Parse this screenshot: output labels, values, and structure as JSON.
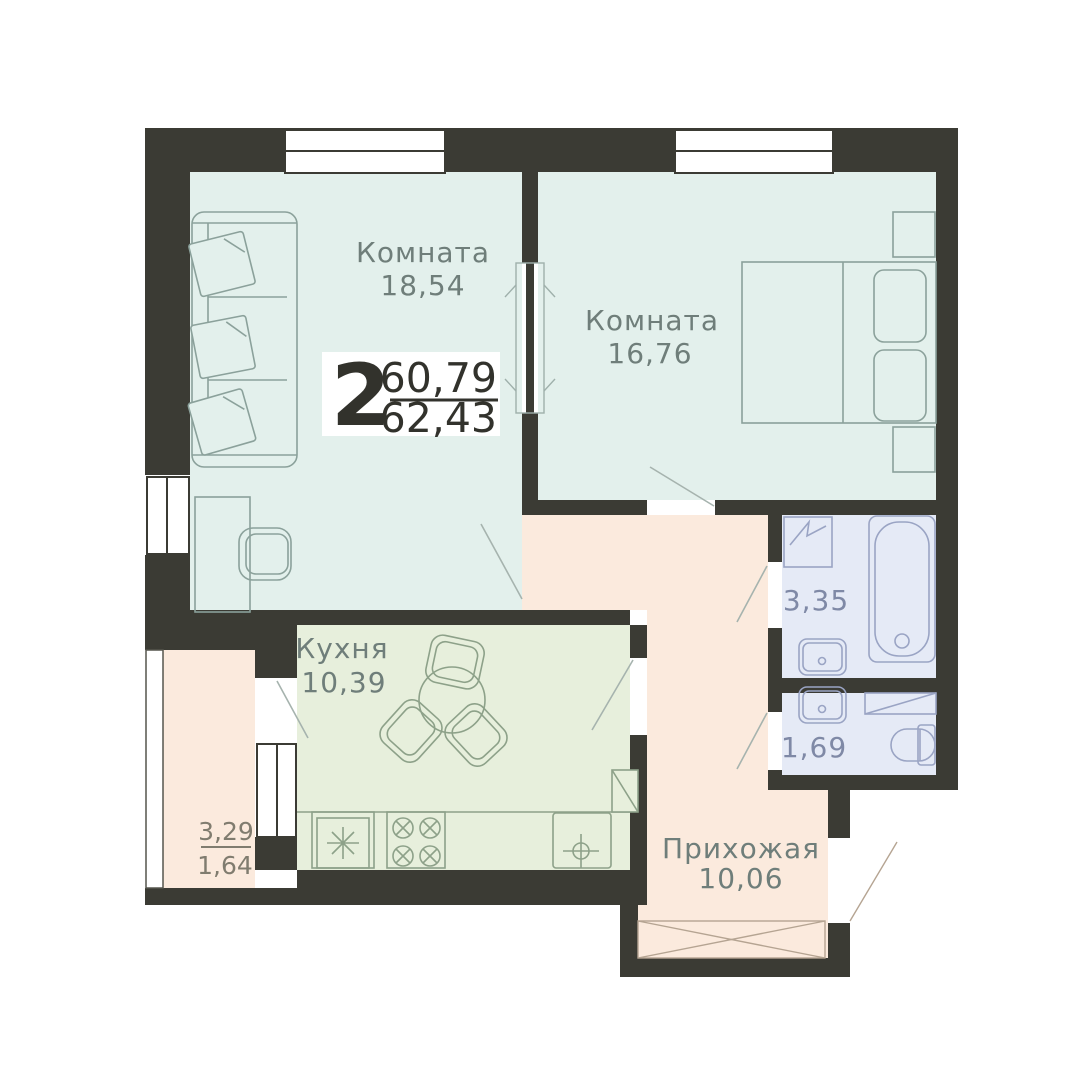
{
  "unit": {
    "rooms_count": "2",
    "area_top": "60,79",
    "area_bottom": "62,43"
  },
  "rooms": {
    "living": {
      "label": "Комната",
      "area": "18,54"
    },
    "bedroom": {
      "label": "Комната",
      "area": "16,76"
    },
    "kitchen": {
      "label": "Кухня",
      "area": "10,39"
    },
    "bathroom": {
      "area": "3,35"
    },
    "wc": {
      "area": "1,69"
    },
    "hallway": {
      "label": "Прихожая",
      "area": "10,06"
    },
    "balcony": {
      "area_top": "3,29",
      "area_bottom": "1,64"
    }
  },
  "colors": {
    "wall": "#3b3b34",
    "room_mint": "#e3f0ec",
    "room_green": "#e7efdc",
    "room_peach": "#fbeadd",
    "room_blue": "#e5eaf6",
    "background": "#ffffff",
    "badge_bg": "#ffffff",
    "badge_text": "#32322c",
    "label_text": "#6f7e7a"
  }
}
